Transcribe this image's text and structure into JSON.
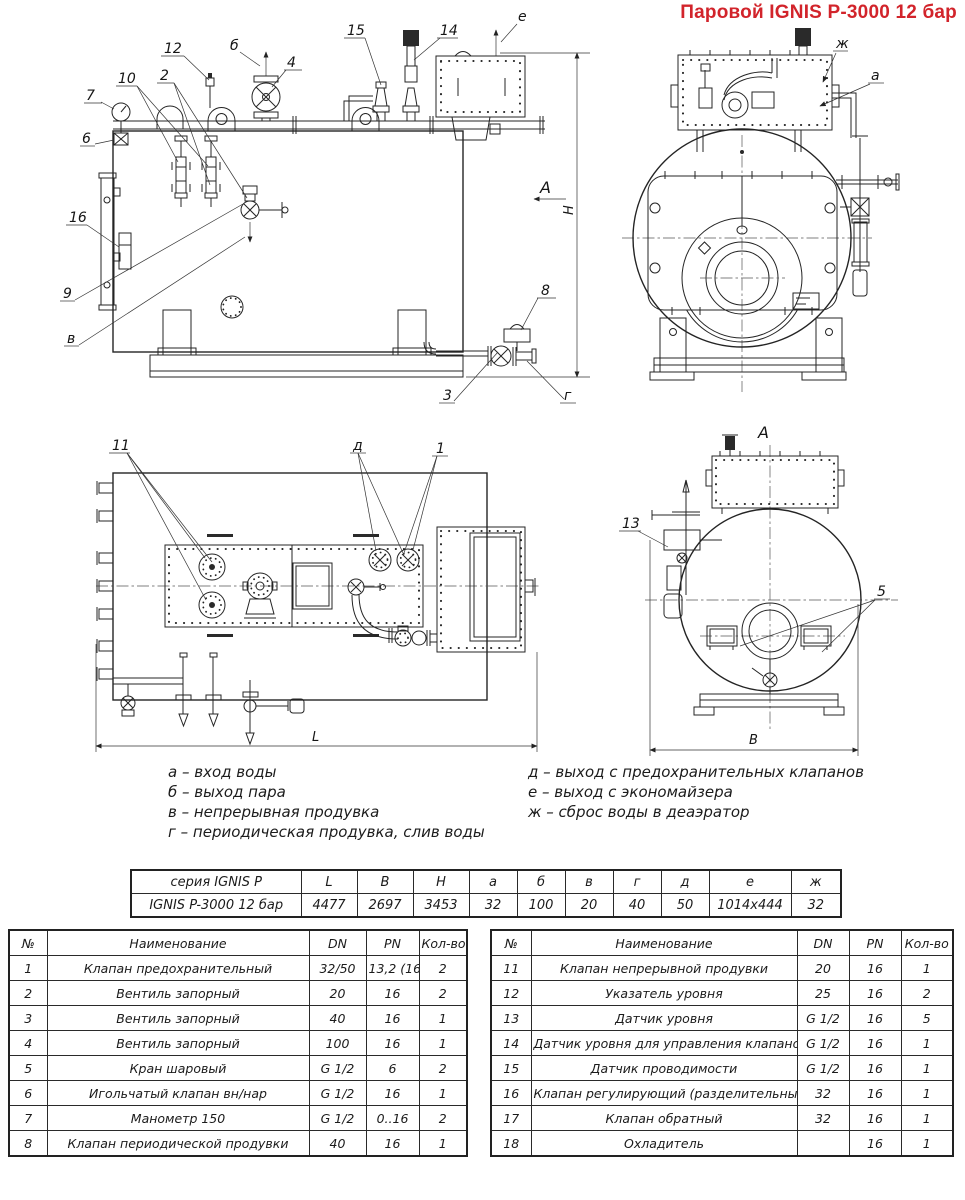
{
  "title": "Паровой IGNIS P-3000 12 бар",
  "callouts": {
    "c7": "7",
    "c6": "6",
    "c10": "10",
    "c2": "2",
    "c12": "12",
    "b": "б",
    "c4": "4",
    "c15": "15",
    "c14": "14",
    "e": "е",
    "c16": "16",
    "c9": "9",
    "v": "в",
    "c8": "8",
    "c3": "3",
    "g": "г",
    "view_arrow": "А",
    "dim_h": "H",
    "zh": "ж",
    "a": "а",
    "c11": "11",
    "d": "д",
    "c1": "1",
    "dim_l": "L",
    "view_a": "А",
    "c13": "13",
    "c5": "5",
    "dim_b": "В"
  },
  "legend": {
    "left": [
      "а – вход воды",
      "б – выход пара",
      "в – непрерывная продувка",
      "г – периодическая продувка, слив воды"
    ],
    "right": [
      "д – выход с предохранительных клапанов",
      "е – выход с экономайзера",
      "ж – сброс воды в деаэратор"
    ]
  },
  "dimensions_table": {
    "header": [
      "серия IGNIS P",
      "L",
      "B",
      "H",
      "а",
      "б",
      "в",
      "г",
      "д",
      "е",
      "ж"
    ],
    "rows": [
      [
        "IGNIS P-3000 12 бар",
        "4477",
        "2697",
        "3453",
        "32",
        "100",
        "20",
        "40",
        "50",
        "1014x444",
        "32"
      ]
    ]
  },
  "parts_table_left": {
    "header": [
      "№",
      "Наименование",
      "DN",
      "PN",
      "Кол-во"
    ],
    "rows": [
      [
        "1",
        "Клапан предохранительный",
        "32/50",
        "13,2 (16)",
        "2"
      ],
      [
        "2",
        "Вентиль запорный",
        "20",
        "16",
        "2"
      ],
      [
        "3",
        "Вентиль запорный",
        "40",
        "16",
        "1"
      ],
      [
        "4",
        "Вентиль запорный",
        "100",
        "16",
        "1"
      ],
      [
        "5",
        "Кран шаровый",
        "G 1/2",
        "6",
        "2"
      ],
      [
        "6",
        "Игольчатый клапан вн/нар",
        "G 1/2",
        "16",
        "1"
      ],
      [
        "7",
        "Манометр 150",
        "G 1/2",
        "0..16",
        "2"
      ],
      [
        "8",
        "Клапан периодической продувки",
        "40",
        "16",
        "1"
      ]
    ]
  },
  "parts_table_right": {
    "header": [
      "№",
      "Наименование",
      "DN",
      "PN",
      "Кол-во"
    ],
    "rows": [
      [
        "11",
        "Клапан непрерывной продувки",
        "20",
        "16",
        "1"
      ],
      [
        "12",
        "Указатель уровня",
        "25",
        "16",
        "2"
      ],
      [
        "13",
        "Датчик уровня",
        "G 1/2",
        "16",
        "5"
      ],
      [
        "14",
        "Датчик уровня для управления клапаном",
        "G 1/2",
        "16",
        "1"
      ],
      [
        "15",
        "Датчик проводимости",
        "G 1/2",
        "16",
        "1"
      ],
      [
        "16",
        "Клапан регулирующий (разделительный)",
        "32",
        "16",
        "1"
      ],
      [
        "17",
        "Клапан обратный",
        "32",
        "16",
        "1"
      ],
      [
        "18",
        "Охладитель",
        "",
        "16",
        "1"
      ]
    ]
  }
}
